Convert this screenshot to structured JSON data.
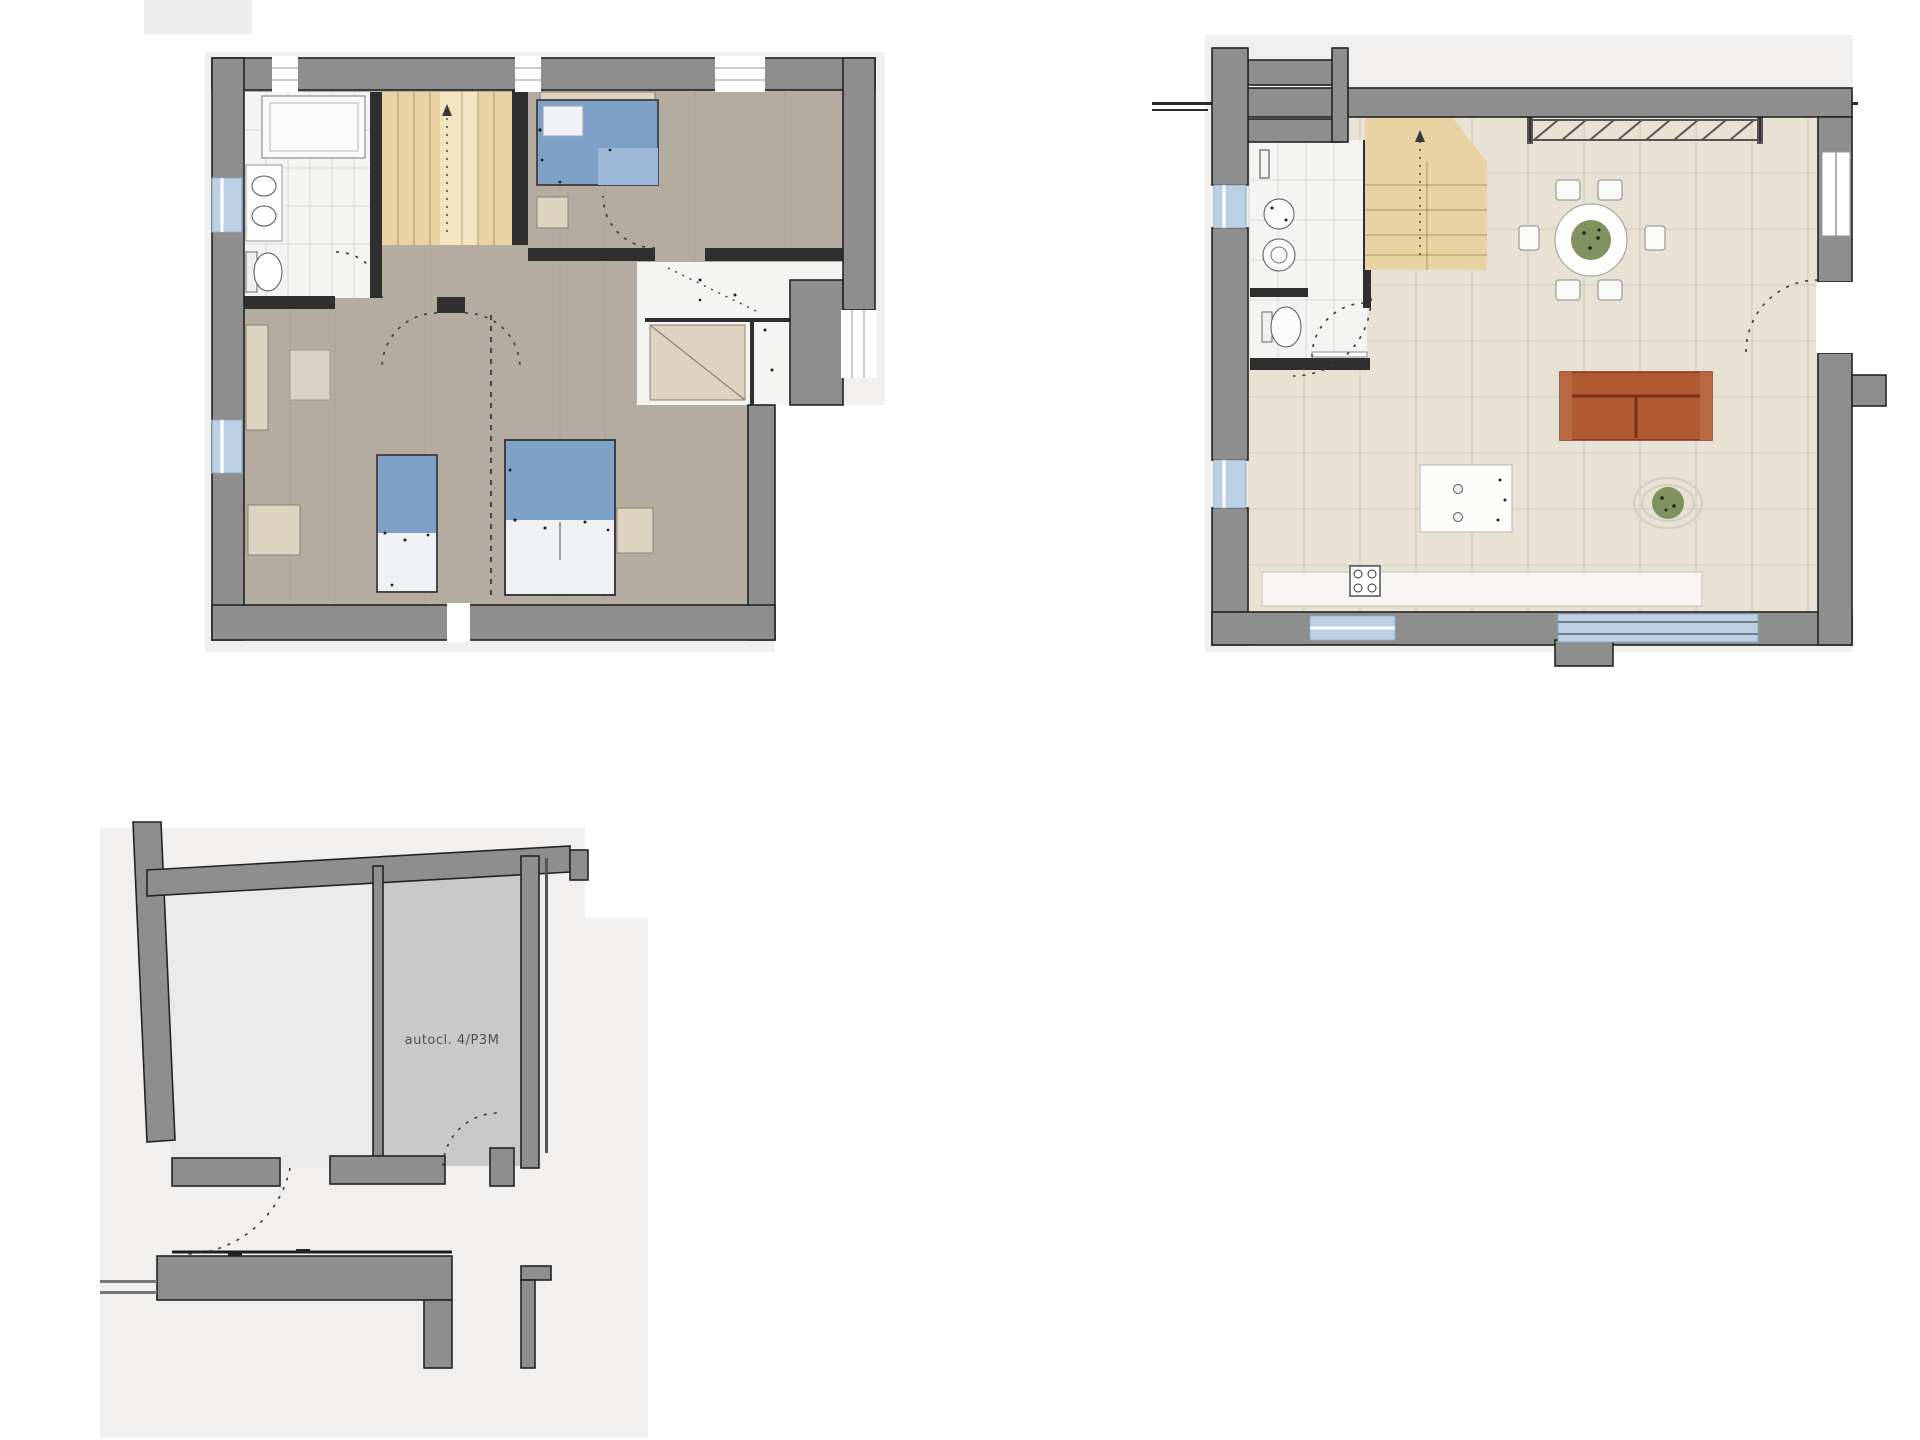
{
  "palette": {
    "wall": "#8e8e8e",
    "wallEdge": "#232323",
    "paper": "#f1f0ee",
    "wood": "#b4aba1",
    "tile": "#f4f4f3",
    "stair": "#ead3a3",
    "stairLight": "#f3e4c2",
    "bedBlue": "#7fa0c7",
    "bedFoot": "#9db8d6",
    "bedWhite": "#eff1f4",
    "beige": "#ddd3c0",
    "sofa": "#b05a34",
    "sofaLine": "#7c3116",
    "plant": "#81915f",
    "winBlue": "#bcd1e5",
    "floorB": "#e8e2d4",
    "roomGray": "#c9c9c9",
    "counter": "#f6f5f2",
    "cornerBlock": "#ededed"
  },
  "plans": {
    "upper_floor": {
      "name": "upper-floor-plan"
    },
    "ground_floor": {
      "name": "ground-floor-plan"
    },
    "basement": {
      "name": "basement-plan",
      "room_label": "autocl. 4/P3M"
    }
  }
}
